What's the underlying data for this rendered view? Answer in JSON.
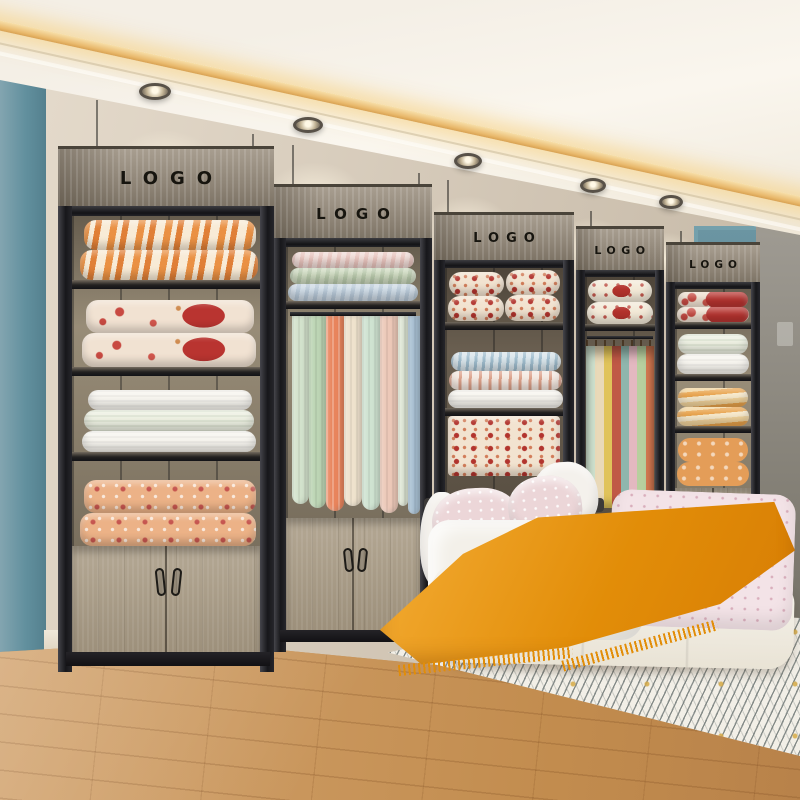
{
  "scene": {
    "type": "bedding-showroom-photo",
    "description": "Retail bedding showroom: five wood-and-black-steel display units with LOGO headers holding folded quilts, hanging fabric drapes and sample hangers; white bed with pink dotted duvet and orange throw on a striped rug; teal accent wall, teal door, warm cove-lit ceiling, wood plank floor",
    "units": [
      {
        "logo": "LOGO",
        "contents": [
          "orange striped quilts",
          "red floral quilts",
          "white quilts",
          "peach patterned quilts",
          "two-door wood cabinet"
        ]
      },
      {
        "logo": "LOGO",
        "contents": [
          "pink, sage and blue folded quilts",
          "hanging pastel fabric drapes",
          "two-door wood cabinet"
        ]
      },
      {
        "logo": "LOGO",
        "contents": [
          "red-and-cream patterned quilts",
          "blue and pink striped quilts",
          "floral fabric"
        ]
      },
      {
        "logo": "LOGO",
        "contents": [
          "red diamond quilts",
          "fabric samples on hangers"
        ]
      },
      {
        "logo": "LOGO",
        "contents": [
          "red floral quilts",
          "white-green quilts",
          "orange striped quilts",
          "orange pillows",
          "wood cabinet"
        ]
      }
    ],
    "bed": {
      "pillows": [
        "white",
        "pink speckled",
        "pink speckled",
        "white"
      ],
      "duvets": [
        "white",
        "pink dotted"
      ],
      "throw": "orange-mustard with fringe",
      "base": "white upholstered"
    },
    "palette": {
      "wall_beige": "#d6cbbc",
      "wall_teal": "#6a95a3",
      "door_teal": "#5b8795",
      "wall_gray": "#8e8b85",
      "ceiling_white": "#f6f2ea",
      "cove_light_gold": "#edbb6d",
      "frame_black": "#202024",
      "header_wood_gray": "#9a9082",
      "cabinet_wood": "#ac9f8b",
      "floor_wood": "#c6925a",
      "rug_white": "#f2efe7",
      "throw_orange": "#e28d08",
      "duvet_pink": "#f3e3e7",
      "quilt_red": "#b93430",
      "quilt_orange": "#e98c3c"
    },
    "lighting": {
      "downlights": 5,
      "cove_strip": "warm gold LED"
    }
  }
}
